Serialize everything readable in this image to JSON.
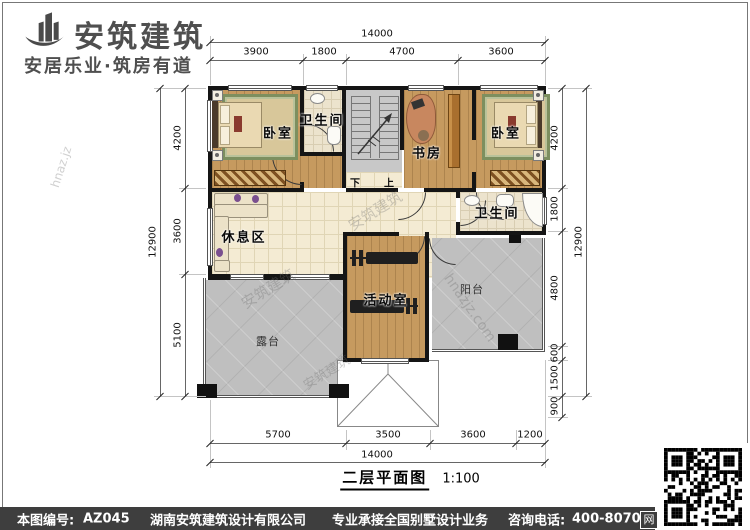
{
  "header": {
    "brand": "安筑建筑",
    "slogan": "安居乐业·筑房有道"
  },
  "plan": {
    "title": "二层平面图",
    "scale": "1:100",
    "rooms": {
      "bedroom_left": "卧室",
      "bath_top": "卫生间",
      "study": "书房",
      "bedroom_right": "卧室",
      "bath_right": "卫生间",
      "lounge": "休息区",
      "activity": "活动室",
      "balcony": "阳台",
      "terrace": "露台"
    },
    "stairs": {
      "down": "下",
      "up": "上"
    },
    "dims": {
      "top_total": "14000",
      "top_segments": [
        "3900",
        "1800",
        "4700",
        "3600"
      ],
      "bottom_segments": [
        "5700",
        "3500",
        "3600",
        "1200"
      ],
      "bottom_total": "14000",
      "left_segments": [
        "4200",
        "3600",
        "5100"
      ],
      "left_total": "12900",
      "right_segments": [
        "4200",
        "1800",
        "4800",
        "600",
        "1500",
        "900"
      ],
      "right_total": "12900"
    },
    "watermarks": {
      "brand": "安筑建筑",
      "site": "hnazjz.com",
      "site_short": "hnaz.jz"
    }
  },
  "footer": {
    "sheet_label": "本图编号:",
    "sheet_no": "AZ045",
    "company": "湖南安筑建筑设计有限公司",
    "service": "专业承接全国别墅设计业务",
    "phone_label": "咨询电话:",
    "phone": "400-8070-511",
    "web_badge": "网"
  },
  "colors": {
    "wall": "#151515",
    "wood_floor": "#c69a5f",
    "tile_floor": "#f4ebd3",
    "terrace_gray": "#bfbfbf",
    "footer_bg": "#3e3e3e",
    "brand_gray": "#4f4f4f"
  }
}
